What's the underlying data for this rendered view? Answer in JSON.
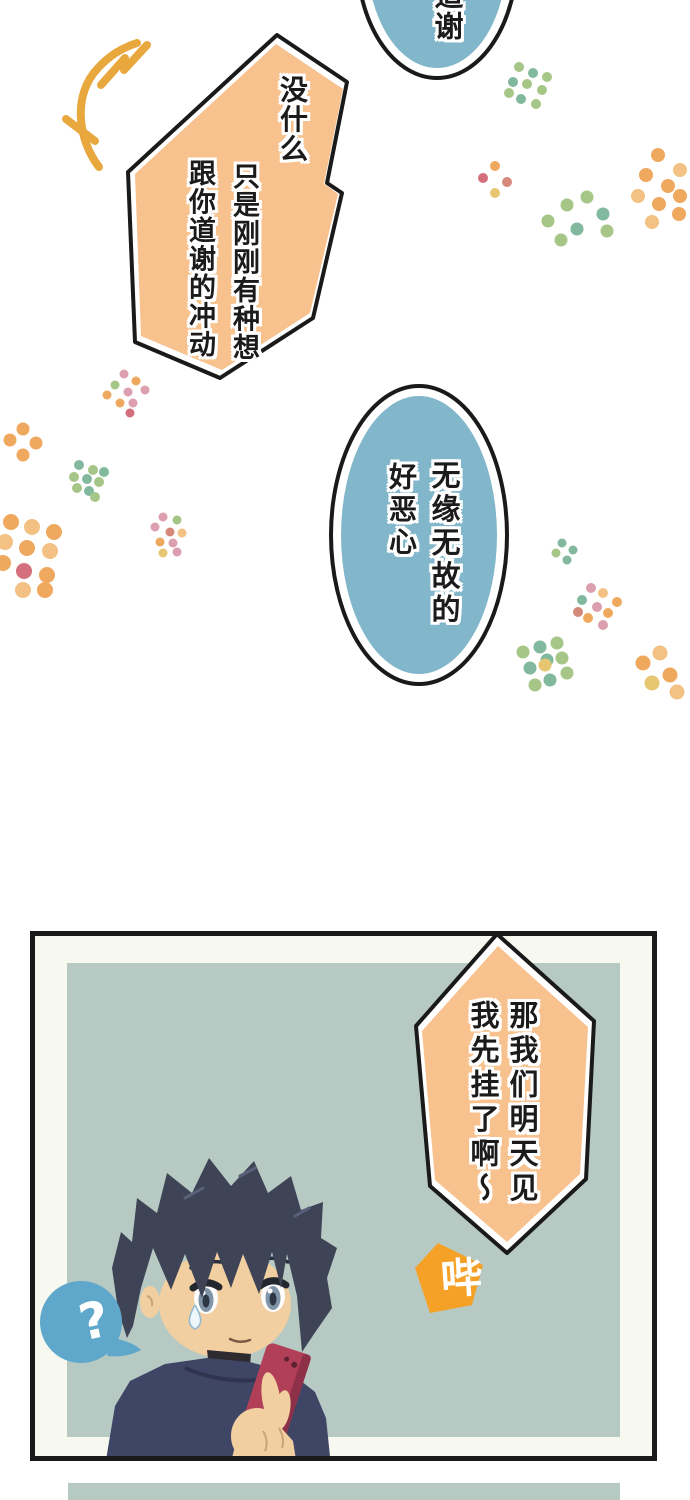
{
  "colors": {
    "background": "#ffffff",
    "outline": "#1a1a1a",
    "bubble_orange": "#f7c28e",
    "bubble_blue": "#82b7cb",
    "sfx_orange": "#f5a127",
    "question_blue": "#5fa7cb",
    "panel_margin": "#f7f8ef",
    "panel_bg": "#b7c9c3",
    "squiggle": "#e9a83e",
    "text": "#1b1b1b",
    "text_halo": "#ffffff"
  },
  "speech": {
    "thanks_top": {
      "column": "道谢"
    },
    "no_biggie": {
      "columns": [
        "没什么",
        "只是刚刚有种想",
        "跟你道谢的冲动"
      ]
    },
    "gross": {
      "columns": [
        "无缘无故的",
        "好恶心"
      ]
    },
    "hang_up": {
      "columns": [
        "那我们明天见",
        "我先挂了啊～"
      ]
    },
    "beep_sfx": "哔",
    "question_mark": "?"
  },
  "character": {
    "hair": "#3e4456",
    "hair_dark": "#333a4c",
    "skin": "#f2cfa1",
    "shirt": "#3f4565",
    "phone": "#b23f58",
    "phone_side": "#8e3047",
    "eye_iris": "#8095a8",
    "eye_dark": "#232830"
  },
  "decor": {
    "palette": {
      "o": "#efa95e",
      "O": "#f3c183",
      "g": "#a6c687",
      "t": "#82b99e",
      "p": "#dc9faf",
      "r": "#d6897b",
      "y": "#e7c672",
      "q": "#d4707e"
    },
    "clusters": [
      {
        "x": 528,
        "y": 86,
        "r": 5,
        "dots": [
          [
            -9,
            -19,
            "g"
          ],
          [
            5,
            -13,
            "t"
          ],
          [
            19,
            -9,
            "g"
          ],
          [
            -15,
            -4,
            "t"
          ],
          [
            -1,
            -2,
            "g"
          ],
          [
            14,
            4,
            "g"
          ],
          [
            -19,
            7,
            "g"
          ],
          [
            -7,
            13,
            "t"
          ],
          [
            8,
            18,
            "g"
          ]
        ]
      },
      {
        "x": 660,
        "y": 188,
        "r": 7,
        "dots": [
          [
            -2,
            -33,
            "o"
          ],
          [
            20,
            -18,
            "O"
          ],
          [
            -14,
            -13,
            "o"
          ],
          [
            8,
            -2,
            "o"
          ],
          [
            -22,
            8,
            "O"
          ],
          [
            20,
            8,
            "o"
          ],
          [
            -1,
            16,
            "o"
          ],
          [
            -8,
            34,
            "O"
          ],
          [
            19,
            26,
            "o"
          ]
        ]
      },
      {
        "x": 495,
        "y": 180,
        "r": 5,
        "dots": [
          [
            0,
            -14,
            "o"
          ],
          [
            -12,
            -2,
            "q"
          ],
          [
            12,
            2,
            "r"
          ],
          [
            0,
            13,
            "y"
          ]
        ]
      },
      {
        "x": 577,
        "y": 213,
        "r": 6.5,
        "dots": [
          [
            -10,
            -8,
            "g"
          ],
          [
            10,
            -16,
            "g"
          ],
          [
            26,
            1,
            "t"
          ],
          [
            -29,
            8,
            "g"
          ],
          [
            0,
            16,
            "t"
          ],
          [
            30,
            18,
            "g"
          ],
          [
            -16,
            27,
            "g"
          ]
        ]
      },
      {
        "x": 126,
        "y": 392,
        "r": 4.5,
        "dots": [
          [
            -2,
            -18,
            "p"
          ],
          [
            10,
            -11,
            "o"
          ],
          [
            -11,
            -7,
            "g"
          ],
          [
            2,
            0,
            "p"
          ],
          [
            19,
            -2,
            "p"
          ],
          [
            -19,
            3,
            "o"
          ],
          [
            -6,
            11,
            "o"
          ],
          [
            7,
            11,
            "p"
          ],
          [
            4,
            21,
            "q"
          ]
        ]
      },
      {
        "x": 23,
        "y": 442,
        "r": 6.5,
        "dots": [
          [
            0,
            -13,
            "o"
          ],
          [
            -13,
            -2,
            "o"
          ],
          [
            13,
            1,
            "o"
          ],
          [
            0,
            13,
            "o"
          ]
        ]
      },
      {
        "x": 88,
        "y": 480,
        "r": 5,
        "dots": [
          [
            -9,
            -15,
            "t"
          ],
          [
            5,
            -10,
            "g"
          ],
          [
            16,
            -8,
            "t"
          ],
          [
            -14,
            -3,
            "g"
          ],
          [
            -1,
            -1,
            "t"
          ],
          [
            11,
            2,
            "g"
          ],
          [
            -11,
            8,
            "g"
          ],
          [
            1,
            11,
            "t"
          ],
          [
            7,
            17,
            "g"
          ]
        ]
      },
      {
        "x": 30,
        "y": 553,
        "r": 8,
        "dots": [
          [
            -19,
            -31,
            "o"
          ],
          [
            2,
            -26,
            "O"
          ],
          [
            24,
            -21,
            "o"
          ],
          [
            -25,
            -11,
            "O"
          ],
          [
            -3,
            -5,
            "o"
          ],
          [
            20,
            -2,
            "O"
          ],
          [
            -27,
            10,
            "o"
          ],
          [
            -6,
            18,
            "q"
          ],
          [
            17,
            22,
            "o"
          ],
          [
            -7,
            37,
            "O"
          ],
          [
            15,
            37,
            "o"
          ]
        ]
      },
      {
        "x": 167,
        "y": 536,
        "r": 4.5,
        "dots": [
          [
            -4,
            -19,
            "p"
          ],
          [
            10,
            -16,
            "g"
          ],
          [
            -12,
            -9,
            "p"
          ],
          [
            3,
            -4,
            "r"
          ],
          [
            15,
            -3,
            "O"
          ],
          [
            -7,
            6,
            "o"
          ],
          [
            6,
            7,
            "p"
          ],
          [
            -4,
            17,
            "y"
          ],
          [
            10,
            16,
            "p"
          ]
        ]
      },
      {
        "x": 565,
        "y": 551,
        "r": 4.5,
        "dots": [
          [
            -3,
            -8,
            "t"
          ],
          [
            8,
            -1,
            "t"
          ],
          [
            -9,
            2,
            "g"
          ],
          [
            2,
            9,
            "t"
          ]
        ]
      },
      {
        "x": 597,
        "y": 606,
        "r": 5,
        "dots": [
          [
            -6,
            -18,
            "p"
          ],
          [
            6,
            -13,
            "O"
          ],
          [
            20,
            -4,
            "o"
          ],
          [
            -15,
            -6,
            "t"
          ],
          [
            0,
            1,
            "p"
          ],
          [
            11,
            7,
            "o"
          ],
          [
            -19,
            6,
            "r"
          ],
          [
            -9,
            12,
            "o"
          ],
          [
            6,
            19,
            "p"
          ]
        ]
      },
      {
        "x": 545,
        "y": 665,
        "r": 6.5,
        "dots": [
          [
            -5,
            -18,
            "t"
          ],
          [
            12,
            -22,
            "g"
          ],
          [
            -22,
            -13,
            "g"
          ],
          [
            2,
            -5,
            "t"
          ],
          [
            17,
            -7,
            "g"
          ],
          [
            -15,
            3,
            "t"
          ],
          [
            0,
            0,
            "y"
          ],
          [
            22,
            8,
            "g"
          ],
          [
            -10,
            20,
            "g"
          ],
          [
            5,
            15,
            "t"
          ]
        ]
      },
      {
        "x": 658,
        "y": 670,
        "r": 7.5,
        "dots": [
          [
            -15,
            -7,
            "o"
          ],
          [
            2,
            -17,
            "O"
          ],
          [
            12,
            5,
            "o"
          ],
          [
            -6,
            13,
            "y"
          ],
          [
            19,
            22,
            "O"
          ]
        ]
      }
    ]
  }
}
